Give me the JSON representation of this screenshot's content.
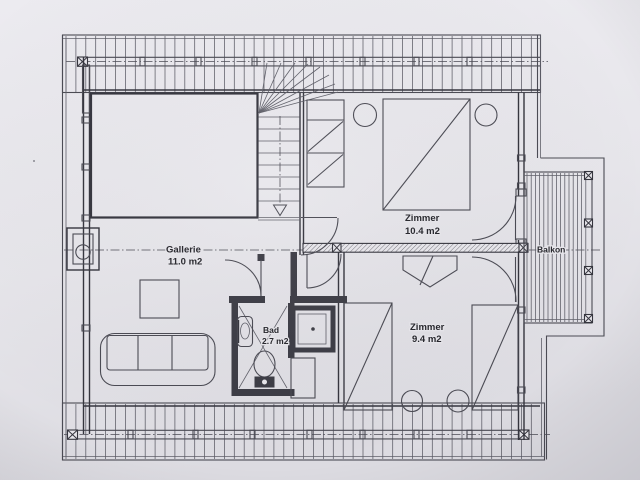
{
  "page": {
    "kind": "scanned floor plan photo",
    "language": "de"
  },
  "colors": {
    "paper": "#e8e7ec",
    "paper_edge": "#d9d8de",
    "ink": "#4b4b54",
    "ink_dark": "#35353e",
    "text": "#27272d"
  },
  "rooms": [
    {
      "id": "gallerie",
      "label": "Gallerie",
      "area": "11.0 m2"
    },
    {
      "id": "zimmer-top",
      "label": "Zimmer",
      "area": "10.4 m2"
    },
    {
      "id": "zimmer-bottom",
      "label": "Zimmer",
      "area": "9.4 m2"
    },
    {
      "id": "bad",
      "label": "Bad",
      "area": "2.7 m2"
    },
    {
      "id": "balkon",
      "label": "Balkon"
    }
  ]
}
